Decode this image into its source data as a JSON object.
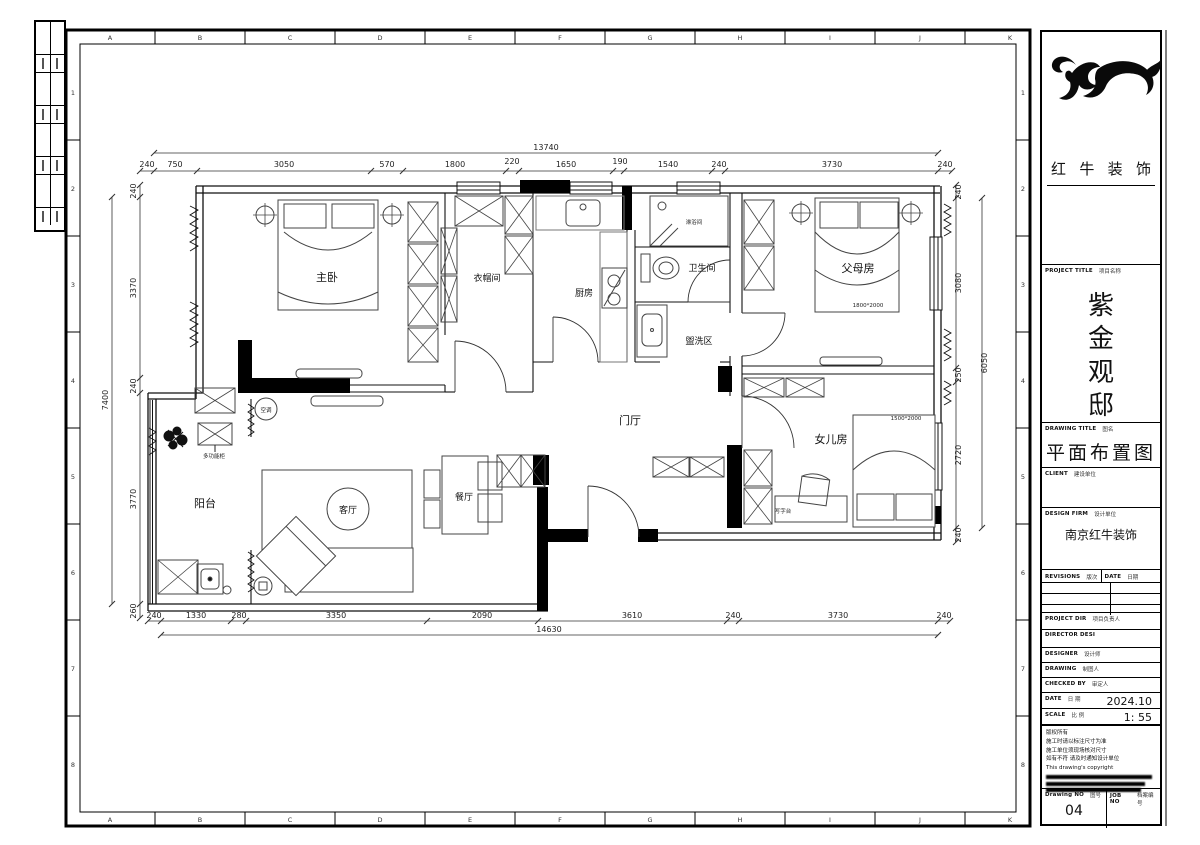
{
  "sheet": {
    "grid_cols": [
      "A",
      "B",
      "C",
      "D",
      "E",
      "F",
      "G",
      "H",
      "I",
      "J",
      "K"
    ],
    "grid_rows": [
      "1",
      "2",
      "3",
      "4",
      "5",
      "6",
      "7",
      "8"
    ]
  },
  "title_block": {
    "company_name_chars": [
      "红",
      "牛",
      "装",
      "饰"
    ],
    "project_title_chars": [
      "紫",
      "金",
      "观",
      "邸"
    ],
    "drawing_title": "平面布置图",
    "design_firm": "南京红牛装饰",
    "date_value": "2024.10",
    "scale_value": "1: 55",
    "drawing_no_value": "04",
    "labels": {
      "project_title_en": "PROJECT TITLE",
      "project_title_zh": "项目名称",
      "drawing_title_en": "DRAWING TITLE",
      "drawing_title_zh": "图名",
      "client_en": "CLIENT",
      "client_zh": "建设单位",
      "design_firm_en": "DESIGN FIRM",
      "design_firm_zh": "设计单位",
      "revisions_en": "REVISIONS",
      "revisions_zh": "版次",
      "date_col_en": "DATE",
      "date_col_zh": "日期",
      "project_dir_en": "PROJECT DIR",
      "project_dir_zh": "项目负责人",
      "director_en": "DIRECTOR DESI",
      "designer_en": "DESIGNER",
      "designer_zh": "设计师",
      "drawing_by_en": "DRAWING",
      "drawing_by_zh": "制图人",
      "checked_by_en": "CHECKED BY",
      "checked_by_zh": "审定人",
      "date_en": "DATE",
      "date_zh": "日 期",
      "scale_en": "SCALE",
      "scale_zh": "比 例",
      "drawing_no_en": "Drawing NO",
      "drawing_no_zh": "图号",
      "job_no_en": "JOB NO",
      "job_no_zh": "档案编号"
    },
    "notes": {
      "l1": "版权所有",
      "l2": "施工时请以标注尺寸为准",
      "l3": "施工单位须现场核对尺寸",
      "l4": "如有不符 请及时通知设计单位",
      "l5": "This drawing's copyright"
    }
  },
  "plan": {
    "rooms": {
      "master": "主卧",
      "cloak": "衣帽间",
      "kitchen": "厨房",
      "bath": "卫生间",
      "shower": "淋浴间",
      "wash": "盥洗区",
      "parents": "父母房",
      "hall": "门厅",
      "dining": "餐厅",
      "living": "客厅",
      "balcony": "阳台",
      "daughter": "女儿房"
    },
    "furniture": {
      "desk": "写字台",
      "multicab": "多功能柜",
      "ac": "空调",
      "parents_bed_size": "1800*2000",
      "daughter_bed_size": "1500*2000"
    },
    "dims": {
      "top": {
        "total": "13740",
        "values": [
          "240",
          "750",
          "3050",
          "570",
          "1800",
          "220",
          "1650",
          "190",
          "1540",
          "240",
          "3730",
          "240"
        ]
      },
      "bottom": {
        "total": "14630",
        "values": [
          "240",
          "1330",
          "280",
          "3350",
          "2090",
          "3610",
          "240",
          "3730",
          "240"
        ]
      },
      "left": {
        "total": "7400",
        "values": [
          "240",
          "3370",
          "240",
          "3770",
          "260"
        ]
      },
      "right": {
        "total": "6050",
        "values": [
          "240",
          "3080",
          "250",
          "2720",
          "240"
        ]
      }
    }
  }
}
